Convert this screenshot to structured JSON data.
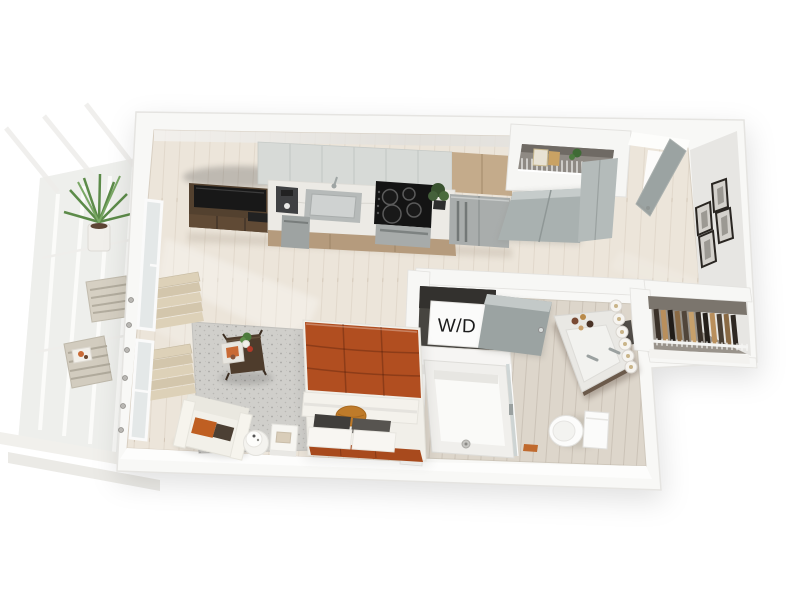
{
  "scene": {
    "title": "Studio apartment 3D floor plan render"
  },
  "labels": {
    "washer_dryer": "W/D"
  },
  "colors": {
    "background": "#ffffff",
    "wall": "#f8f8f6",
    "wall_edge": "#e5e4e1",
    "wall_face_east": "#e7e6e3",
    "floor_wood": "#ece5da",
    "floor_bath": "#ddd6cb",
    "rug_gray": "#d0cfcb",
    "bed_duvet_rust": "#b14e20",
    "bed_foot_rust": "#a84a1d",
    "bolster_orange": "#bf7b2a",
    "pillow_dark": "#403e3b",
    "chair_white": "#f2f0e9",
    "chair_pillow_orange": "#bf5f22",
    "chair_pillow_brown": "#4c4034",
    "table_wood_dark": "#4e3c2c",
    "tv_console_wood": "#53412f",
    "tv_black": "#181818",
    "kitchen_upper_gray": "#d7dad7",
    "kitchen_wood_tan": "#c4ab8b",
    "lower_cabinet_tan": "#b59b7d",
    "counter_marble": "#eceae5",
    "cooktop_black": "#141414",
    "steel_appliance": "#a9adac",
    "door_gray": "#9ba3a2",
    "bifold_gray": "#a9b1b0",
    "closet_interior": "#99938b",
    "clothes_dark": "#3a3129",
    "clothes_tan": "#b98f5c",
    "vanity_marble": "#e9e8e4",
    "vanity_wood": "#6b5a4b",
    "fixture_white": "#fbfbfa",
    "blind_beige": "#ddd1b8",
    "plant_green": "#5c8b49",
    "balcony_glass": "#e9ebea"
  },
  "rooms": [
    {
      "name": "kitchen"
    },
    {
      "name": "living-sleeping-area"
    },
    {
      "name": "bathroom"
    },
    {
      "name": "entry-hall"
    },
    {
      "name": "closet"
    },
    {
      "name": "washer-dryer-closet"
    },
    {
      "name": "balcony"
    }
  ],
  "objects": [
    "tv-console",
    "television",
    "coffee-maker",
    "kitchen-sink",
    "faucet",
    "cooktop",
    "oven",
    "counter-plant",
    "dishwasher",
    "refrigerator",
    "upper-cabinets",
    "entry-shelf",
    "bifold-doors",
    "entry-door",
    "picture-frames",
    "hanging-clothes",
    "wire-shelf",
    "washer-dryer",
    "bathroom-door",
    "vanity-sink",
    "vanity-lights",
    "toilet",
    "shower",
    "shower-glass",
    "area-rug",
    "coffee-table",
    "armchair",
    "bed",
    "bed-pillows",
    "side-table",
    "table-lamp",
    "roman-shades",
    "window",
    "balcony-plant",
    "outdoor-bench"
  ]
}
